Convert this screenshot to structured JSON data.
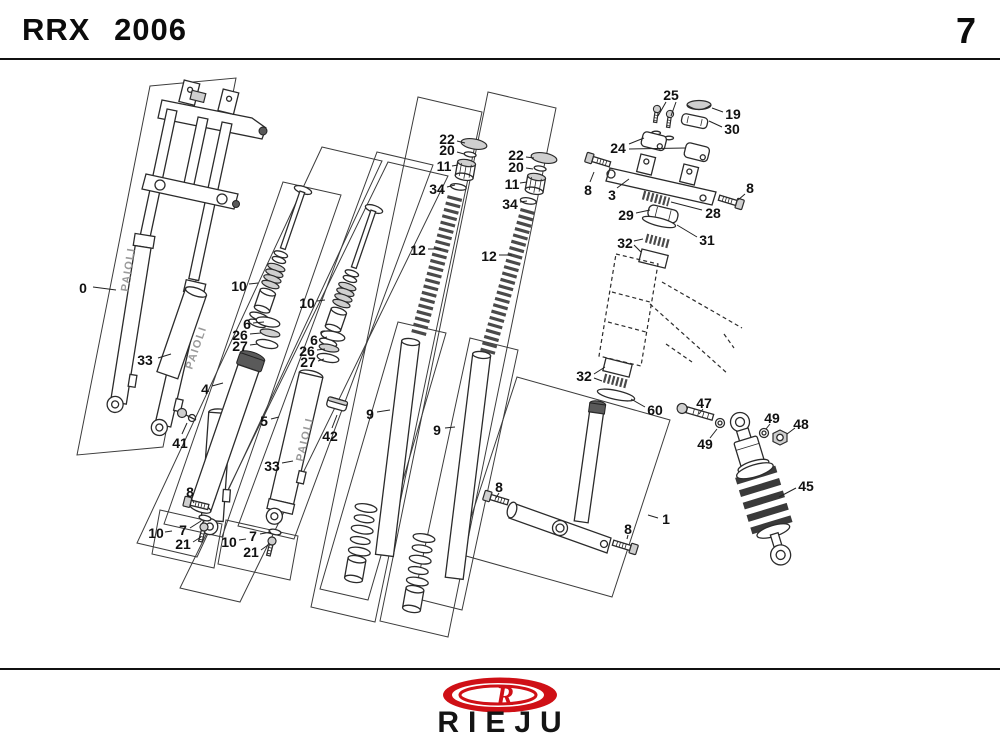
{
  "header": {
    "title": "RRX 2006",
    "page_number": "7"
  },
  "footer": {
    "brand": "RIEJU",
    "logo_letter": "R"
  },
  "colors": {
    "accent_red": "#cf1016",
    "line": "#2b2b2b"
  },
  "diagram": {
    "tube_brand": "PAIOLI",
    "labels": [
      {
        "t": "0",
        "x": 83,
        "y": 296,
        "leaders": [
          [
            93,
            295,
            116,
            298
          ]
        ]
      },
      {
        "t": "33",
        "x": 145,
        "y": 368,
        "leaders": [
          [
            158,
            366,
            171,
            362
          ]
        ]
      },
      {
        "t": "41",
        "x": 180,
        "y": 451,
        "leaders": [
          [
            182,
            442,
            187,
            431
          ]
        ]
      },
      {
        "t": "4",
        "x": 205,
        "y": 397,
        "leaders": [
          [
            212,
            394,
            223,
            391
          ]
        ]
      },
      {
        "t": "10",
        "x": 239,
        "y": 294,
        "leaders": [
          [
            249,
            292,
            258,
            291
          ]
        ]
      },
      {
        "t": "6",
        "x": 247,
        "y": 332,
        "leaders": [
          [
            253,
            331,
            264,
            330
          ]
        ]
      },
      {
        "t": "26",
        "x": 240,
        "y": 343,
        "leaders": [
          [
            250,
            342,
            261,
            341
          ]
        ]
      },
      {
        "t": "27",
        "x": 240,
        "y": 354,
        "leaders": [
          [
            250,
            353,
            258,
            352
          ]
        ]
      },
      {
        "t": "8",
        "x": 190,
        "y": 500,
        "leaders": [
          [
            191,
            506,
            194,
            511
          ]
        ]
      },
      {
        "t": "7",
        "x": 183,
        "y": 538,
        "leaders": [
          [
            190,
            536,
            201,
            529
          ]
        ]
      },
      {
        "t": "10",
        "x": 156,
        "y": 541,
        "leaders": [
          [
            165,
            540,
            172,
            539
          ]
        ]
      },
      {
        "t": "21",
        "x": 183,
        "y": 552,
        "leaders": [
          [
            193,
            550,
            201,
            545
          ]
        ]
      },
      {
        "t": "33",
        "x": 272,
        "y": 474,
        "leaders": [
          [
            282,
            471,
            293,
            469
          ]
        ]
      },
      {
        "t": "5",
        "x": 264,
        "y": 429,
        "leaders": [
          [
            271,
            427,
            279,
            425
          ]
        ]
      },
      {
        "t": "10",
        "x": 307,
        "y": 311,
        "leaders": [
          [
            317,
            309,
            325,
            308
          ]
        ]
      },
      {
        "t": "6",
        "x": 314,
        "y": 348,
        "leaders": [
          [
            320,
            347,
            327,
            345
          ]
        ]
      },
      {
        "t": "26",
        "x": 307,
        "y": 359,
        "leaders": [
          [
            317,
            358,
            325,
            357
          ]
        ]
      },
      {
        "t": "27",
        "x": 308,
        "y": 370,
        "leaders": [
          [
            318,
            369,
            324,
            367
          ]
        ]
      },
      {
        "t": "7",
        "x": 253,
        "y": 544,
        "leaders": [
          [
            260,
            542,
            271,
            540
          ]
        ]
      },
      {
        "t": "10",
        "x": 229,
        "y": 550,
        "leaders": [
          [
            239,
            548,
            246,
            547
          ]
        ]
      },
      {
        "t": "21",
        "x": 251,
        "y": 560,
        "leaders": [
          [
            261,
            558,
            268,
            553
          ]
        ]
      },
      {
        "t": "42",
        "x": 330,
        "y": 444,
        "leaders": [
          [
            332,
            436,
            337,
            423
          ]
        ]
      },
      {
        "t": "22",
        "x": 447,
        "y": 147,
        "leaders": [
          [
            457,
            149,
            465,
            151
          ]
        ]
      },
      {
        "t": "20",
        "x": 447,
        "y": 158,
        "leaders": [
          [
            457,
            160,
            464,
            162
          ]
        ]
      },
      {
        "t": "11",
        "x": 444,
        "y": 174,
        "leaders": [
          [
            452,
            174,
            458,
            173
          ]
        ]
      },
      {
        "t": "34",
        "x": 437,
        "y": 197,
        "leaders": [
          [
            447,
            195,
            455,
            193
          ]
        ]
      },
      {
        "t": "12",
        "x": 418,
        "y": 258,
        "leaders": [
          [
            428,
            257,
            441,
            257
          ]
        ]
      },
      {
        "t": "22",
        "x": 516,
        "y": 163,
        "leaders": [
          [
            526,
            165,
            534,
            166
          ]
        ]
      },
      {
        "t": "20",
        "x": 516,
        "y": 175,
        "leaders": [
          [
            526,
            176,
            533,
            177
          ]
        ]
      },
      {
        "t": "11",
        "x": 512,
        "y": 192,
        "leaders": [
          [
            520,
            191,
            527,
            190
          ]
        ]
      },
      {
        "t": "34",
        "x": 510,
        "y": 212,
        "leaders": [
          [
            520,
            210,
            527,
            209
          ]
        ]
      },
      {
        "t": "12",
        "x": 489,
        "y": 264,
        "leaders": [
          [
            499,
            263,
            512,
            263
          ]
        ]
      },
      {
        "t": "9",
        "x": 370,
        "y": 422,
        "leaders": [
          [
            377,
            420,
            390,
            418
          ]
        ]
      },
      {
        "t": "9",
        "x": 437,
        "y": 438,
        "leaders": [
          [
            445,
            436,
            455,
            435
          ]
        ]
      },
      {
        "t": "25",
        "x": 671,
        "y": 103,
        "leaders": [
          [
            666,
            110,
            658,
            124
          ],
          [
            676,
            110,
            671,
            124
          ]
        ]
      },
      {
        "t": "19",
        "x": 733,
        "y": 122,
        "leaders": [
          [
            723,
            120,
            712,
            116
          ]
        ]
      },
      {
        "t": "30",
        "x": 732,
        "y": 137,
        "leaders": [
          [
            722,
            135,
            709,
            129
          ]
        ]
      },
      {
        "t": "24",
        "x": 618,
        "y": 156,
        "leaders": [
          [
            629,
            152,
            644,
            146
          ],
          [
            629,
            157,
            685,
            156
          ]
        ]
      },
      {
        "t": "3",
        "x": 612,
        "y": 203,
        "leaders": [
          [
            617,
            196,
            629,
            187
          ]
        ]
      },
      {
        "t": "8",
        "x": 588,
        "y": 198,
        "leaders": [
          [
            590,
            190,
            594,
            180
          ]
        ]
      },
      {
        "t": "8",
        "x": 750,
        "y": 196,
        "leaders": [
          [
            745,
            202,
            738,
            208
          ]
        ]
      },
      {
        "t": "29",
        "x": 626,
        "y": 223,
        "leaders": [
          [
            636,
            221,
            650,
            218
          ]
        ]
      },
      {
        "t": "28",
        "x": 713,
        "y": 221,
        "leaders": [
          [
            702,
            218,
            671,
            210
          ]
        ]
      },
      {
        "t": "31",
        "x": 707,
        "y": 248,
        "leaders": [
          [
            697,
            245,
            677,
            233
          ]
        ]
      },
      {
        "t": "32",
        "x": 625,
        "y": 251,
        "leaders": [
          [
            634,
            249,
            643,
            247
          ],
          [
            634,
            253,
            641,
            260
          ]
        ]
      },
      {
        "t": "32",
        "x": 584,
        "y": 384,
        "leaders": [
          [
            594,
            382,
            605,
            375
          ],
          [
            594,
            386,
            602,
            389
          ]
        ]
      },
      {
        "t": "60",
        "x": 655,
        "y": 418,
        "leaders": [
          [
            645,
            415,
            631,
            407
          ]
        ]
      },
      {
        "t": "47",
        "x": 704,
        "y": 411,
        "leaders": [
          [
            703,
            417,
            699,
            422
          ]
        ]
      },
      {
        "t": "49",
        "x": 705,
        "y": 452,
        "leaders": [
          [
            710,
            446,
            717,
            437
          ]
        ]
      },
      {
        "t": "49",
        "x": 772,
        "y": 426,
        "leaders": [
          [
            770,
            432,
            766,
            437
          ]
        ]
      },
      {
        "t": "48",
        "x": 801,
        "y": 432,
        "leaders": [
          [
            795,
            436,
            787,
            442
          ]
        ]
      },
      {
        "t": "45",
        "x": 806,
        "y": 494,
        "leaders": [
          [
            796,
            496,
            779,
            505
          ]
        ]
      },
      {
        "t": "1",
        "x": 666,
        "y": 527,
        "leaders": [
          [
            658,
            526,
            648,
            523
          ]
        ]
      },
      {
        "t": "8",
        "x": 499,
        "y": 495,
        "leaders": [
          [
            499,
            501,
            496,
            506
          ]
        ]
      },
      {
        "t": "8",
        "x": 628,
        "y": 537,
        "leaders": [
          [
            628,
            543,
            627,
            547
          ]
        ]
      }
    ]
  }
}
